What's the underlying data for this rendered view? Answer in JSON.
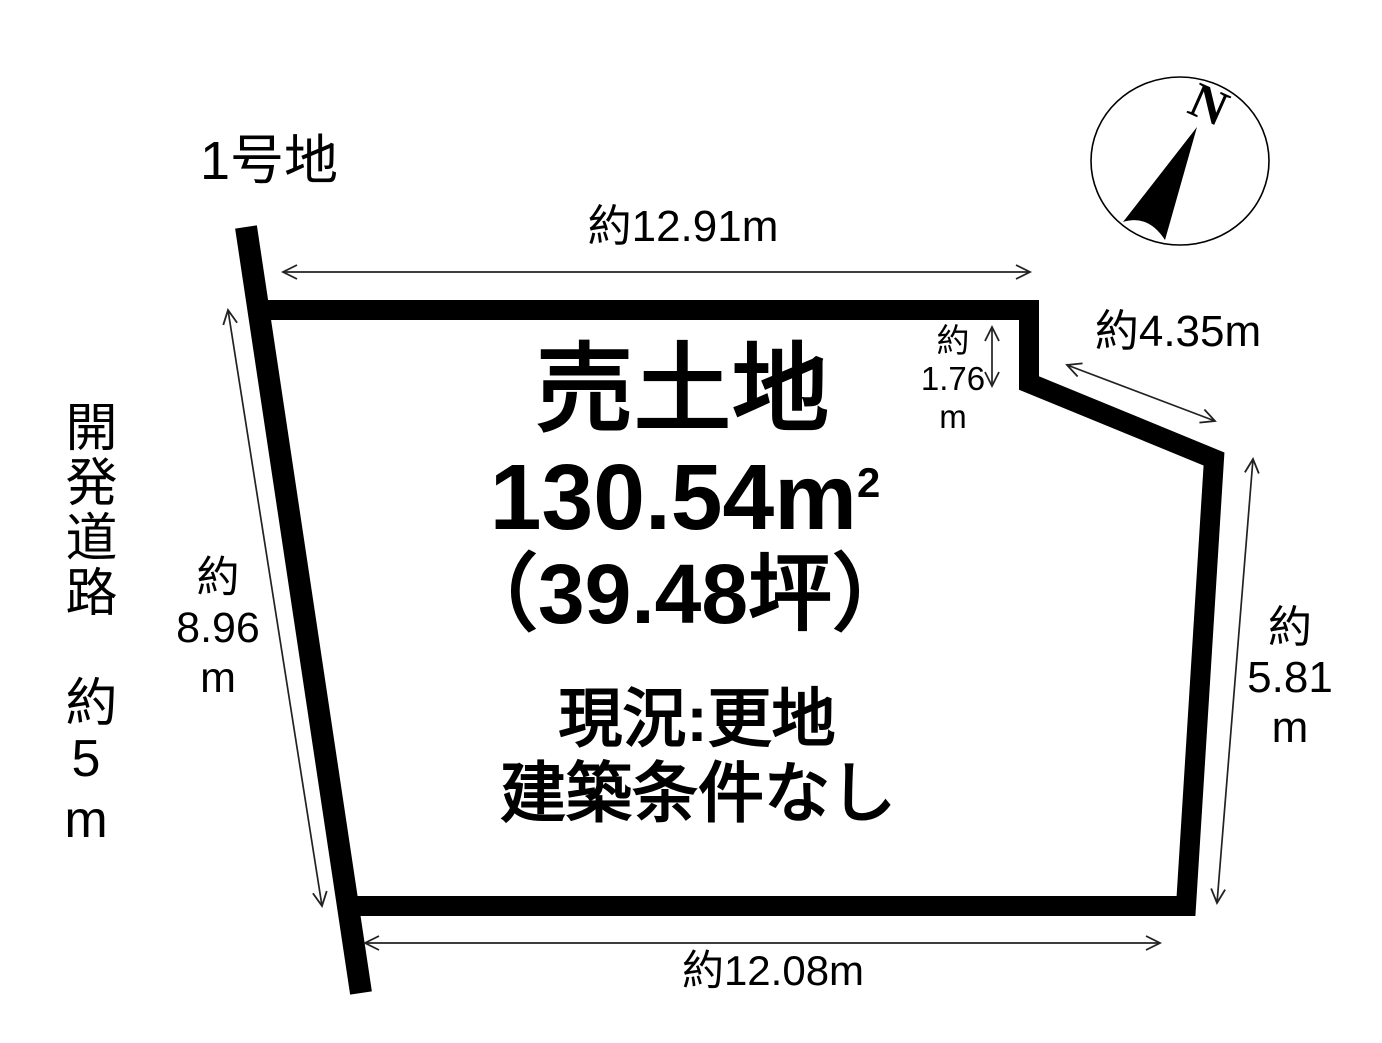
{
  "lot_label": "1号地",
  "road_label": "開発道路　約5m",
  "compass": {
    "north_label": "N"
  },
  "parcel": {
    "title": "売土地",
    "area_value": "130.54m",
    "area_sup": "2",
    "area_tsubo": "（39.48坪）",
    "status": "現況:更地",
    "condition": "建築条件なし"
  },
  "dimensions": {
    "top_edge": "約12.91m",
    "left_edge": "約\n8.96\nm",
    "notch_edge": "約\n1.76\nm",
    "diagonal_edge": "約4.35m",
    "right_edge": "約\n5.81\nm",
    "bottom_edge": "約12.08m"
  },
  "colors": {
    "ink": "#000000",
    "dimension_line": "#222222",
    "background": "#ffffff"
  }
}
